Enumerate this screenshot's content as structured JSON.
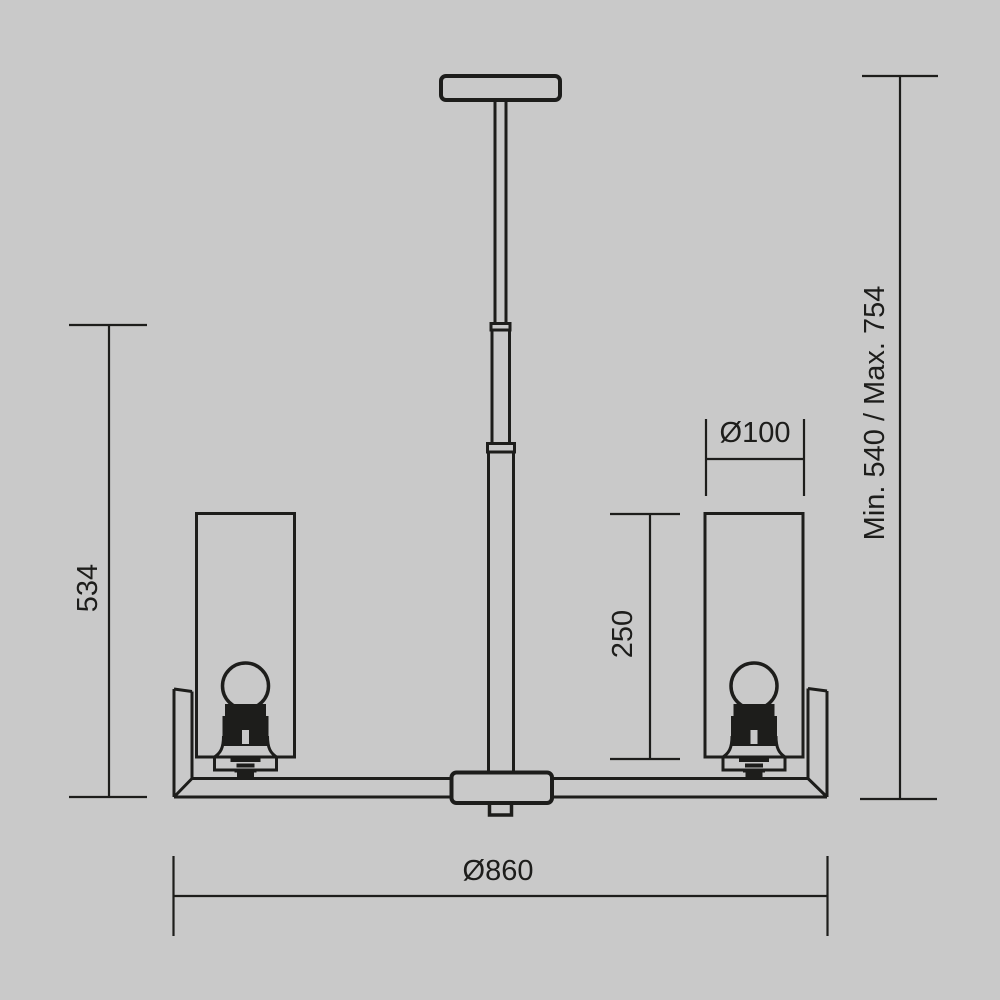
{
  "canvas": {
    "background_color": "#c9c9c9",
    "line_color": "#1d1d1b"
  },
  "drawing": {
    "labels": {
      "left_height": "534",
      "suspension_range": "Min. 540 / Max. 754",
      "shade_diameter": "Ø100",
      "shade_height": "250",
      "overall_diameter": "Ø860"
    }
  }
}
